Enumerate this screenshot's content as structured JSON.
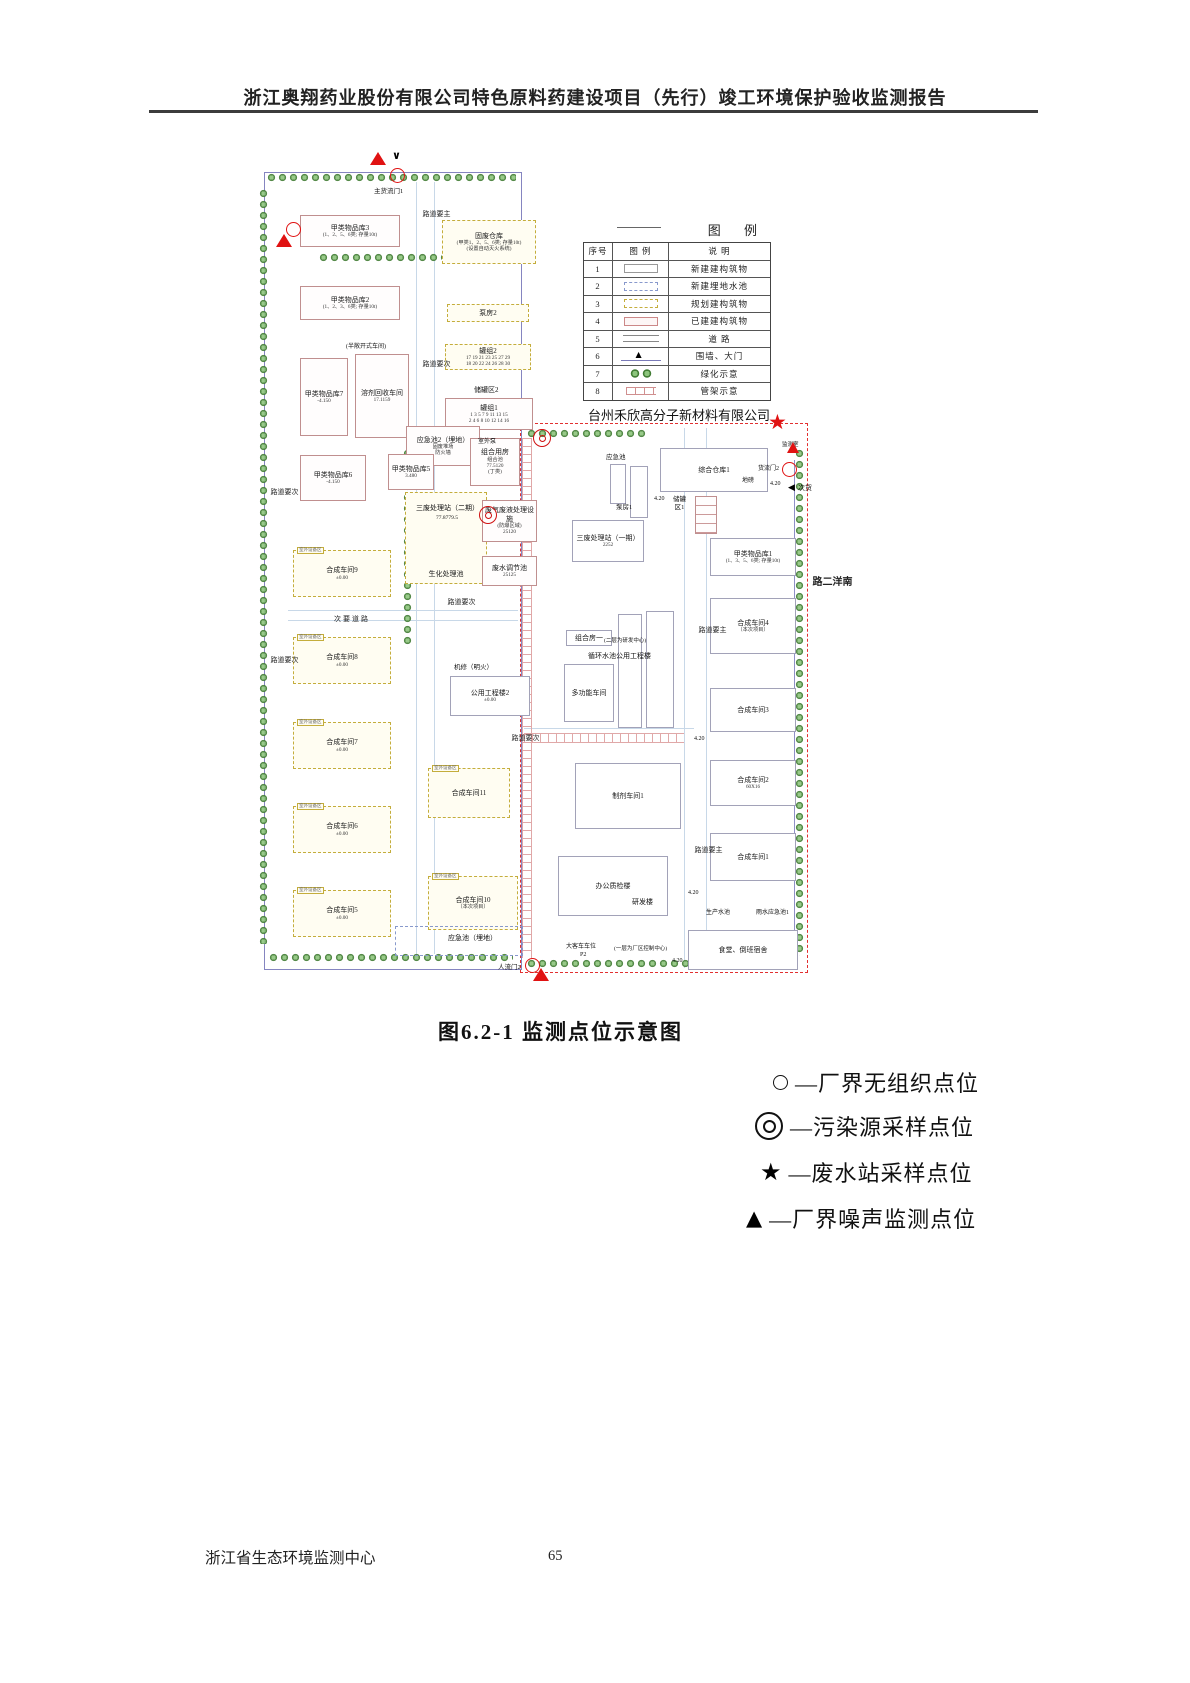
{
  "page": {
    "header": "浙江奥翔药业股份有限公司特色原料药建设项目（先行）竣工环境保护验收监测报告",
    "caption": "图6.2-1  监测点位示意图",
    "footer_left": "浙江省生态环境监测中心",
    "page_number": "65"
  },
  "colors": {
    "marker_red": "#e01212",
    "fence_blue": "#8585c0",
    "boundary_red_dashed": "#e23030",
    "planned_yellow": "#c4ad3c",
    "existing_pink": "#c08f8f",
    "greenery": "#417c34"
  },
  "legend_table": {
    "title": "图  例",
    "headers": [
      "序号",
      "图  例",
      "说  明"
    ],
    "rows": [
      {
        "no": "1",
        "swatch": "new-building",
        "desc": "新建建构筑物"
      },
      {
        "no": "2",
        "swatch": "buried-pool",
        "desc": "新建埋地水池"
      },
      {
        "no": "3",
        "swatch": "planned-building",
        "desc": "规划建构筑物"
      },
      {
        "no": "4",
        "swatch": "existing-building",
        "desc": "已建建构筑物"
      },
      {
        "no": "5",
        "swatch": "road",
        "desc": "道  路"
      },
      {
        "no": "6",
        "swatch": "fence-gate",
        "desc": "围墙、大门"
      },
      {
        "no": "7",
        "swatch": "greenery",
        "desc": "绿化示意"
      },
      {
        "no": "8",
        "swatch": "pipe-rack",
        "desc": "管架示意"
      }
    ]
  },
  "point_legend": [
    {
      "symbol": "circle",
      "label": "—厂界无组织点位",
      "x": 773,
      "y": 1066
    },
    {
      "symbol": "double-circle",
      "label": "—污染源采样点位",
      "x": 755,
      "y": 1110
    },
    {
      "symbol": "star",
      "label": "—废水站采样点位",
      "x": 760,
      "y": 1156
    },
    {
      "symbol": "triangle",
      "label": "—厂界噪声监测点位",
      "x": 746,
      "y": 1202
    }
  ],
  "diagram": {
    "company_north": "台州禾欣高分子新材料有限公司",
    "buildings": [
      {
        "id": "jialei3",
        "x": 42,
        "y": 67,
        "w": 100,
        "h": 32,
        "s": "e",
        "lines": [
          "甲类物品库3",
          "(1、2、5、6类; 存量10t)"
        ]
      },
      {
        "id": "gufei-cangku",
        "x": 184,
        "y": 72,
        "w": 94,
        "h": 44,
        "s": "p",
        "lines": [
          "固废仓库",
          "(甲类1、2、5、6类; 存量10t)",
          "(设置自动灭火系统)"
        ]
      },
      {
        "id": "jialei2",
        "x": 42,
        "y": 138,
        "w": 100,
        "h": 34,
        "s": "e",
        "lines": [
          "甲类物品库2",
          "(1、2、3、6类; 存量10t)"
        ]
      },
      {
        "id": "bengfang2",
        "x": 189,
        "y": 156,
        "w": 82,
        "h": 18,
        "s": "p",
        "lines": [
          "泵房2"
        ]
      },
      {
        "id": "guanzu2",
        "x": 187,
        "y": 196,
        "w": 86,
        "h": 26,
        "s": "p",
        "lines": [
          "罐组2",
          "17 19 21 23 25 27 29",
          "18 20 22 24 26 28 30"
        ]
      },
      {
        "id": "guanzu1",
        "x": 187,
        "y": 250,
        "w": 88,
        "h": 32,
        "s": "e",
        "lines": [
          "罐组1",
          "1 3 5 7 9 11 13 15",
          "2 4 6 8 10 12 14 16"
        ]
      },
      {
        "id": "rongji-huishou",
        "x": 97,
        "y": 206,
        "w": 54,
        "h": 84,
        "s": "e",
        "lines": [
          "溶剂回收车间",
          "17.1159"
        ]
      },
      {
        "id": "jialei7",
        "x": 42,
        "y": 210,
        "w": 48,
        "h": 78,
        "s": "e",
        "lines": [
          "甲类物品库7",
          "-4.150"
        ]
      },
      {
        "id": "yingjichi2",
        "x": 148,
        "y": 278,
        "w": 74,
        "h": 40,
        "s": "e",
        "lines": [
          "应急池2（埋地）",
          "固废堆场",
          "防火墙"
        ]
      },
      {
        "id": "zuheyongfang",
        "x": 212,
        "y": 290,
        "w": 50,
        "h": 48,
        "s": "e",
        "lines": [
          "组合用房",
          "组合池",
          "77.5120",
          "(丁类)"
        ]
      },
      {
        "id": "jialei6",
        "x": 42,
        "y": 307,
        "w": 66,
        "h": 46,
        "s": "e",
        "lines": [
          "甲类物品库6",
          "-4.150"
        ]
      },
      {
        "id": "jialei5",
        "x": 130,
        "y": 306,
        "w": 46,
        "h": 36,
        "s": "e",
        "lines": [
          "甲类物品库5",
          "3.480"
        ]
      },
      {
        "id": "shenghua-chi",
        "x": 147,
        "y": 344,
        "w": 82,
        "h": 92,
        "s": "p",
        "lines": [
          "生化处理池"
        ],
        "lp": "b"
      },
      {
        "id": "feiqi-feiye",
        "x": 224,
        "y": 352,
        "w": 55,
        "h": 42,
        "s": "e",
        "lines": [
          "废气废液处理设施",
          "(防爆区域)",
          "25120"
        ]
      },
      {
        "id": "feishui-tiaojie",
        "x": 224,
        "y": 408,
        "w": 55,
        "h": 30,
        "s": "e",
        "lines": [
          "废水调节池",
          "25125"
        ]
      },
      {
        "id": "hecheng9",
        "x": 35,
        "y": 402,
        "w": 98,
        "h": 47,
        "s": "p",
        "lines": [
          "合成车间9",
          "±0.00"
        ],
        "tag": "室外设备区"
      },
      {
        "id": "hecheng8",
        "x": 35,
        "y": 489,
        "w": 98,
        "h": 47,
        "s": "p",
        "lines": [
          "合成车间8",
          "±0.00"
        ],
        "tag": "室外设备区"
      },
      {
        "id": "hecheng7",
        "x": 35,
        "y": 574,
        "w": 98,
        "h": 47,
        "s": "p",
        "lines": [
          "合成车间7",
          "±0.00"
        ],
        "tag": "室外设备区"
      },
      {
        "id": "hecheng6",
        "x": 35,
        "y": 658,
        "w": 98,
        "h": 47,
        "s": "p",
        "lines": [
          "合成车间6",
          "±0.00"
        ],
        "tag": "室外设备区"
      },
      {
        "id": "hecheng5",
        "x": 35,
        "y": 742,
        "w": 98,
        "h": 47,
        "s": "p",
        "lines": [
          "合成车间5",
          "±0.00"
        ],
        "tag": "室外设备区"
      },
      {
        "id": "gongyong-lou2",
        "x": 192,
        "y": 528,
        "w": 80,
        "h": 40,
        "s": "n",
        "lines": [
          "公用工程楼2",
          "±0.00"
        ]
      },
      {
        "id": "hecheng11",
        "x": 170,
        "y": 620,
        "w": 82,
        "h": 50,
        "s": "p",
        "lines": [
          "合成车间11"
        ],
        "tag": "室外设备区"
      },
      {
        "id": "hecheng10",
        "x": 170,
        "y": 728,
        "w": 90,
        "h": 54,
        "s": "p",
        "lines": [
          "合成车间10",
          "（本次项目）"
        ],
        "tag": "室外设备区"
      },
      {
        "id": "yingjichi-buried-box",
        "x": 137,
        "y": 778,
        "w": 128,
        "h": 30,
        "s": "pool",
        "lines": []
      },
      {
        "id": "zonghe-cangku1",
        "x": 402,
        "y": 300,
        "w": 108,
        "h": 44,
        "s": "n",
        "lines": [
          "综合仓库1"
        ]
      },
      {
        "id": "yingjichi-right-box",
        "x": 352,
        "y": 316,
        "w": 16,
        "h": 40,
        "s": "n",
        "lines": []
      },
      {
        "id": "bengfang1-box",
        "x": 372,
        "y": 318,
        "w": 18,
        "h": 52,
        "s": "n",
        "lines": []
      },
      {
        "id": "chuguan-qu1-tanks",
        "x": 437,
        "y": 348,
        "w": 22,
        "h": 38,
        "s": "e",
        "grid": true,
        "lines": []
      },
      {
        "id": "sanfei-yiqi",
        "x": 314,
        "y": 372,
        "w": 72,
        "h": 42,
        "s": "n",
        "lines": [
          "三废处理站（一期）",
          "2252"
        ]
      },
      {
        "id": "jialei1",
        "x": 452,
        "y": 390,
        "w": 86,
        "h": 38,
        "s": "n",
        "lines": [
          "甲类物品库1",
          "(1、3、5、6类; 存量10t)"
        ]
      },
      {
        "id": "hecheng4",
        "x": 452,
        "y": 450,
        "w": 86,
        "h": 56,
        "s": "n",
        "lines": [
          "合成车间4",
          "（本次项目）"
        ]
      },
      {
        "id": "hecheng3",
        "x": 452,
        "y": 540,
        "w": 86,
        "h": 44,
        "s": "n",
        "lines": [
          "合成车间3"
        ]
      },
      {
        "id": "hecheng2",
        "x": 452,
        "y": 612,
        "w": 86,
        "h": 46,
        "s": "n",
        "lines": [
          "合成车间2",
          "60X16"
        ]
      },
      {
        "id": "hecheng1",
        "x": 452,
        "y": 685,
        "w": 86,
        "h": 48,
        "s": "n",
        "lines": [
          "合成车间1"
        ]
      },
      {
        "id": "zhiji1",
        "x": 317,
        "y": 615,
        "w": 106,
        "h": 66,
        "s": "n",
        "lines": [
          "制剂车间1"
        ]
      },
      {
        "id": "duogongneng",
        "x": 306,
        "y": 516,
        "w": 50,
        "h": 58,
        "s": "n",
        "lines": [
          "多功能车间"
        ]
      },
      {
        "id": "zuhefang1",
        "x": 308,
        "y": 482,
        "w": 46,
        "h": 16,
        "s": "n",
        "lines": [
          "组合房一"
        ]
      },
      {
        "id": "xunhuan-a",
        "x": 360,
        "y": 466,
        "w": 24,
        "h": 114,
        "s": "n",
        "lines": []
      },
      {
        "id": "xunhuan-b",
        "x": 388,
        "y": 463,
        "w": 28,
        "h": 117,
        "s": "n",
        "lines": []
      },
      {
        "id": "bangong-zhijian",
        "x": 300,
        "y": 708,
        "w": 110,
        "h": 60,
        "s": "n",
        "lines": [
          "办公质检楼"
        ]
      },
      {
        "id": "shitang-sushe",
        "x": 430,
        "y": 782,
        "w": 110,
        "h": 40,
        "s": "n",
        "lines": [
          "食堂、倒班宿舍"
        ]
      }
    ],
    "labels": [
      {
        "id": "gate-main-cargo",
        "t": "主货流门1",
        "x": 116,
        "y": 40,
        "fs": 6.5
      },
      {
        "id": "company-north",
        "t": "台州禾欣高分子新材料有限公司",
        "x": 330,
        "y": 260,
        "fs": 13
      },
      {
        "id": "semi-open-note",
        "t": "(半敞开式车间)",
        "x": 88,
        "y": 196,
        "fs": 6
      },
      {
        "id": "tank-area2",
        "t": "储罐区2",
        "x": 216,
        "y": 238,
        "fs": 7
      },
      {
        "id": "outdoor-pump",
        "t": "室外泵",
        "x": 220,
        "y": 291,
        "fs": 6
      },
      {
        "id": "sanfei-erqi",
        "t": "三废处理站（二期）",
        "x": 158,
        "y": 356,
        "fs": 7
      },
      {
        "id": "sanfei-erqi-elev",
        "t": "77.8779.5",
        "x": 178,
        "y": 367,
        "fs": 5.5
      },
      {
        "id": "jixiu",
        "t": "机修（明火）",
        "x": 196,
        "y": 516,
        "fs": 6.5
      },
      {
        "id": "jiance-shi",
        "t": "监测室",
        "x": 524,
        "y": 294,
        "fs": 5.5
      },
      {
        "id": "gate-cargo2",
        "t": "货流门2",
        "x": 500,
        "y": 318,
        "fs": 6
      },
      {
        "id": "dibang",
        "t": "地磅",
        "x": 484,
        "y": 330,
        "fs": 6
      },
      {
        "id": "cihuo",
        "t": "次货",
        "x": 540,
        "y": 336,
        "fs": 7
      },
      {
        "id": "elev-420-a",
        "t": "4.20",
        "x": 512,
        "y": 333,
        "fs": 6
      },
      {
        "id": "elev-420-b",
        "t": "4.20",
        "x": 396,
        "y": 348,
        "fs": 6
      },
      {
        "id": "elev-420-c",
        "t": "4.20",
        "x": 436,
        "y": 588,
        "fs": 6
      },
      {
        "id": "elev-420-d",
        "t": "4.20",
        "x": 430,
        "y": 742,
        "fs": 6
      },
      {
        "id": "elev-420-e",
        "t": "4.20",
        "x": 414,
        "y": 810,
        "fs": 6
      },
      {
        "id": "yingjichi-right",
        "t": "应急池",
        "x": 348,
        "y": 306,
        "fs": 6.5
      },
      {
        "id": "bengfang1",
        "t": "泵房1",
        "x": 358,
        "y": 356,
        "fs": 6.5
      },
      {
        "id": "tank-area1",
        "t": "储罐区1",
        "x": 414,
        "y": 348,
        "fs": 6.5,
        "w": 15
      },
      {
        "id": "erceng-note",
        "t": "(二层为研发中心)",
        "x": 346,
        "y": 490,
        "fs": 5.5
      },
      {
        "id": "xunhuan-label",
        "t": "循环水池公用工程楼",
        "x": 330,
        "y": 504,
        "fs": 7
      },
      {
        "id": "yanfalou",
        "t": "研发楼",
        "x": 374,
        "y": 750,
        "fs": 7
      },
      {
        "id": "yiceng-note",
        "t": "(一层为厂区控制中心)",
        "x": 356,
        "y": 798,
        "fs": 5.5
      },
      {
        "id": "shengchan-shuichi",
        "t": "生产水池",
        "x": 448,
        "y": 762,
        "fs": 6
      },
      {
        "id": "yushui-yingjichi1",
        "t": "雨水应急池1",
        "x": 498,
        "y": 762,
        "fs": 6
      },
      {
        "id": "bus-parking",
        "t": "大客车车位",
        "x": 308,
        "y": 796,
        "fs": 6
      },
      {
        "id": "bus-parking-p2",
        "t": "P2",
        "x": 322,
        "y": 804,
        "fs": 6
      },
      {
        "id": "gate-people2",
        "t": "人流门2",
        "x": 240,
        "y": 816,
        "fs": 6.5
      },
      {
        "id": "yingjichi-buried",
        "t": "应急池（埋地）",
        "x": 190,
        "y": 786,
        "fs": 7
      }
    ],
    "roads": [
      {
        "id": "road-main-1",
        "t": "主要道路",
        "x": 164,
        "y": 62,
        "v": 1
      },
      {
        "id": "road-sec-1",
        "t": "次要道路",
        "x": 164,
        "y": 212,
        "v": 1
      },
      {
        "id": "road-sec-2",
        "t": "次要道路",
        "x": 12,
        "y": 340,
        "v": 1
      },
      {
        "id": "road-sec-3",
        "t": "次要道路",
        "x": 12,
        "y": 508,
        "v": 1
      },
      {
        "id": "road-sec-4",
        "t": "次要道路",
        "x": 76,
        "y": 466,
        "v": 0
      },
      {
        "id": "road-sec-5",
        "t": "次要道路",
        "x": 189,
        "y": 450,
        "v": 1
      },
      {
        "id": "road-sec-6",
        "t": "次要道路",
        "x": 253,
        "y": 586,
        "v": 1
      },
      {
        "id": "road-main-2",
        "t": "主要道路",
        "x": 440,
        "y": 478,
        "v": 1
      },
      {
        "id": "road-main-3",
        "t": "主要道路",
        "x": 436,
        "y": 698,
        "v": 1
      },
      {
        "id": "road-nanyang",
        "t": "南洋二路",
        "x": 552,
        "y": 428,
        "v": 1,
        "south": 1
      }
    ],
    "markers": [
      {
        "id": "noise-point-north",
        "k": "tri",
        "x": 112,
        "y": 4,
        "s": 16
      },
      {
        "id": "gate-arrow-north",
        "k": "varr",
        "x": 134,
        "y": 2,
        "s": 11
      },
      {
        "id": "fenceline-point-north",
        "k": "circ",
        "x": 132,
        "y": 20,
        "s": 13
      },
      {
        "id": "fenceline-point-west",
        "k": "circ",
        "x": 28,
        "y": 74,
        "s": 13
      },
      {
        "id": "noise-point-west",
        "k": "tri",
        "x": 18,
        "y": 86,
        "s": 16
      },
      {
        "id": "wastewater-sampling-point",
        "k": "star",
        "x": 510,
        "y": 264,
        "s": 21
      },
      {
        "id": "noise-point-east",
        "k": "tri",
        "x": 529,
        "y": 294,
        "s": 13
      },
      {
        "id": "fenceline-point-east",
        "k": "circ",
        "x": 524,
        "y": 314,
        "s": 13
      },
      {
        "id": "source-sampling-point-1",
        "k": "dcirc",
        "x": 275,
        "y": 281,
        "s": 16
      },
      {
        "id": "source-sampling-point-2",
        "k": "dcirc",
        "x": 221,
        "y": 358,
        "s": 16
      },
      {
        "id": "fenceline-point-south",
        "k": "circ",
        "x": 267,
        "y": 810,
        "s": 13
      },
      {
        "id": "noise-point-south",
        "k": "tri",
        "x": 275,
        "y": 820,
        "s": 16
      },
      {
        "id": "gate-arrow-east",
        "k": "larr",
        "x": 530,
        "y": 336,
        "s": 9
      }
    ],
    "trees": [
      {
        "x": 8,
        "y": 24,
        "w": 250,
        "h": 12
      },
      {
        "x": 0,
        "y": 40,
        "w": 12,
        "h": 756
      },
      {
        "x": 60,
        "y": 104,
        "w": 130,
        "h": 12
      },
      {
        "x": 144,
        "y": 300,
        "w": 12,
        "h": 200
      },
      {
        "x": 10,
        "y": 804,
        "w": 245,
        "h": 12
      },
      {
        "x": 268,
        "y": 280,
        "w": 120,
        "h": 12
      },
      {
        "x": 268,
        "y": 810,
        "w": 262,
        "h": 12
      },
      {
        "x": 536,
        "y": 300,
        "w": 12,
        "h": 508
      }
    ],
    "racks": [
      {
        "x": 264,
        "y": 290,
        "w": 8,
        "h": 520,
        "dir": "v"
      },
      {
        "x": 266,
        "y": 585,
        "w": 160,
        "h": 8,
        "dir": "h"
      }
    ],
    "rlines": [
      {
        "x": 158,
        "y": 34,
        "w": 1,
        "h": 772
      },
      {
        "x": 176,
        "y": 34,
        "w": 1,
        "h": 772
      },
      {
        "x": 30,
        "y": 462,
        "w": 230,
        "h": 1
      },
      {
        "x": 30,
        "y": 472,
        "w": 230,
        "h": 1
      },
      {
        "x": 426,
        "y": 280,
        "w": 1,
        "h": 540
      },
      {
        "x": 448,
        "y": 280,
        "w": 1,
        "h": 540
      },
      {
        "x": 266,
        "y": 580,
        "w": 170,
        "h": 1
      }
    ]
  }
}
